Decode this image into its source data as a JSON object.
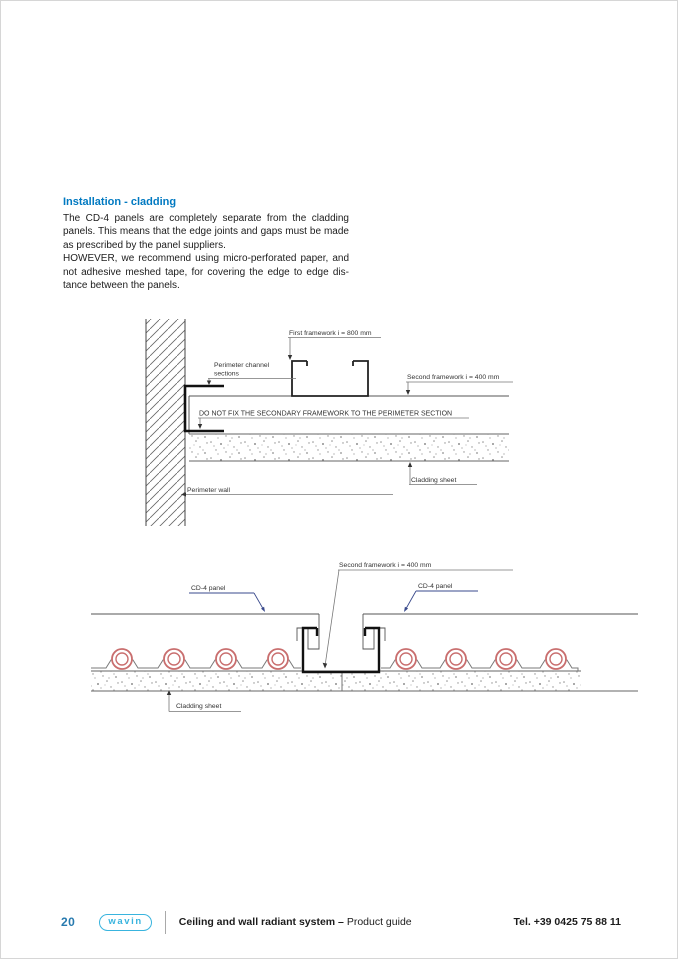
{
  "intro": {
    "heading": "Installation - cladding",
    "lines": [
      "The CD-4 panels are completely separate from the cladding",
      "panels. This means that the edge joints and gaps must be made",
      "as prescribed by the panel suppliers.",
      "HOWEVER, we recommend using micro-perforated paper, and",
      "not adhesive meshed tape, for covering the edge to edge dis-",
      "tance between the panels."
    ]
  },
  "diagram1": {
    "labels": {
      "first_framework": "First framework i = 800 mm",
      "perimeter_channel_1": "Perimeter channel",
      "perimeter_channel_2": "sections",
      "do_not_fix": "DO NOT FIX THE SECONDARY FRAMEWORK TO THE PERIMETER SECTION",
      "second_framework": "Second framework i = 400 mm",
      "cladding_sheet": "Cladding sheet",
      "perimeter_wall": "Perimeter wall"
    }
  },
  "diagram2": {
    "labels": {
      "second_framework": "Second framework i = 400 mm",
      "cd4_left": "CD-4 panel",
      "cd4_right": "CD-4 panel",
      "cladding_sheet": "Cladding sheet"
    }
  },
  "footer": {
    "page_number": "20",
    "logo_text": "wavin",
    "title_bold": "Ceiling and wall radiant system –",
    "title_regular": "Product guide",
    "phone": "Tel. +39 0425 75 88 11"
  },
  "colors": {
    "accent_blue": "#0079c1",
    "brand_cyan": "#39b4de",
    "pipe_red": "#c96e6e",
    "line_dark": "#111111",
    "line_gray": "#555555"
  }
}
